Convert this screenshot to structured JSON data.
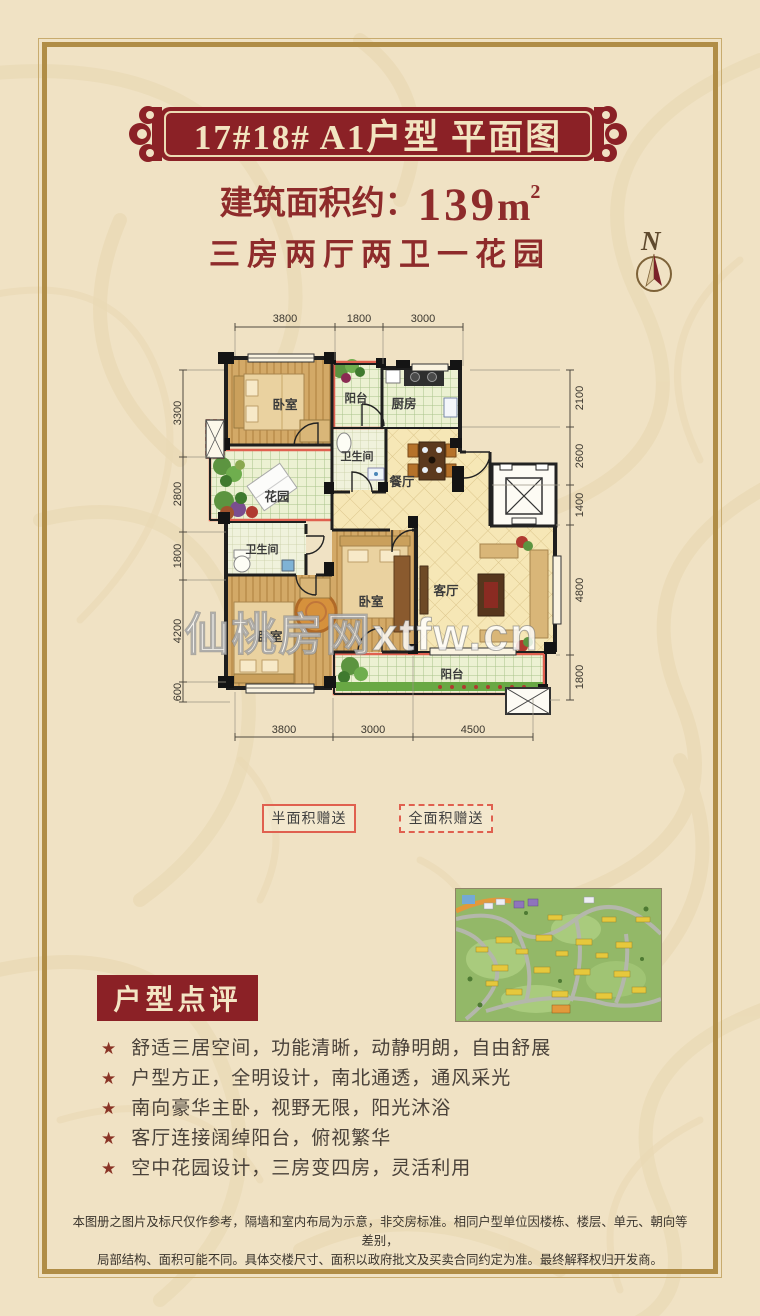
{
  "page": {
    "background": "#f0e2c4",
    "frame_gold": "#b08d46",
    "accent_red": "#8b2126",
    "text_red": "#8e2b2b"
  },
  "header": {
    "banner_title": "17#18# A1户型 平面图",
    "area_label": "建筑面积约：",
    "area_value": "139",
    "area_unit": "m",
    "area_sup": "2",
    "subtitle": "三房两厅两卫一花园",
    "compass_n": "N"
  },
  "floor_plan": {
    "watermark": "仙桃房网xtfw.cn",
    "rooms": [
      {
        "label": "卧室"
      },
      {
        "label": "阳台"
      },
      {
        "label": "厨房"
      },
      {
        "label": "卫生间"
      },
      {
        "label": "餐厅"
      },
      {
        "label": "花园"
      },
      {
        "label": "卫生间"
      },
      {
        "label": "卧室"
      },
      {
        "label": "卧室"
      },
      {
        "label": "客厅"
      },
      {
        "label": "阳台"
      }
    ],
    "dimensions": {
      "top": [
        "3800",
        "1800",
        "3000"
      ],
      "bottom": [
        "3800",
        "3000",
        "4500"
      ],
      "left": [
        "3300",
        "2800",
        "1800",
        "4200",
        "600"
      ],
      "right": [
        "2100",
        "2600",
        "1400",
        "4800",
        "1800"
      ]
    }
  },
  "legend": {
    "half": "半面积赠送",
    "full": "全面积赠送"
  },
  "review": {
    "heading": "户型点评",
    "star": "★",
    "items": [
      "舒适三居空间，功能清晰，动静明朗，自由舒展",
      "户型方正，全明设计，南北通透，通风采光",
      "南向豪华主卧，视野无限，阳光沐浴",
      "客厅连接阔绰阳台，俯视繁华",
      "空中花园设计，三房变四房，灵活利用"
    ]
  },
  "disclaimer": {
    "line1": "本图册之图片及标尺仅作参考，隔墙和室内布局为示意，非交房标准。相同户型单位因楼栋、楼层、单元、朝向等差别，",
    "line2": "局部结构、面积可能不同。具体交楼尺寸、面积以政府批文及买卖合同约定为准。最终解释权归开发商。"
  }
}
